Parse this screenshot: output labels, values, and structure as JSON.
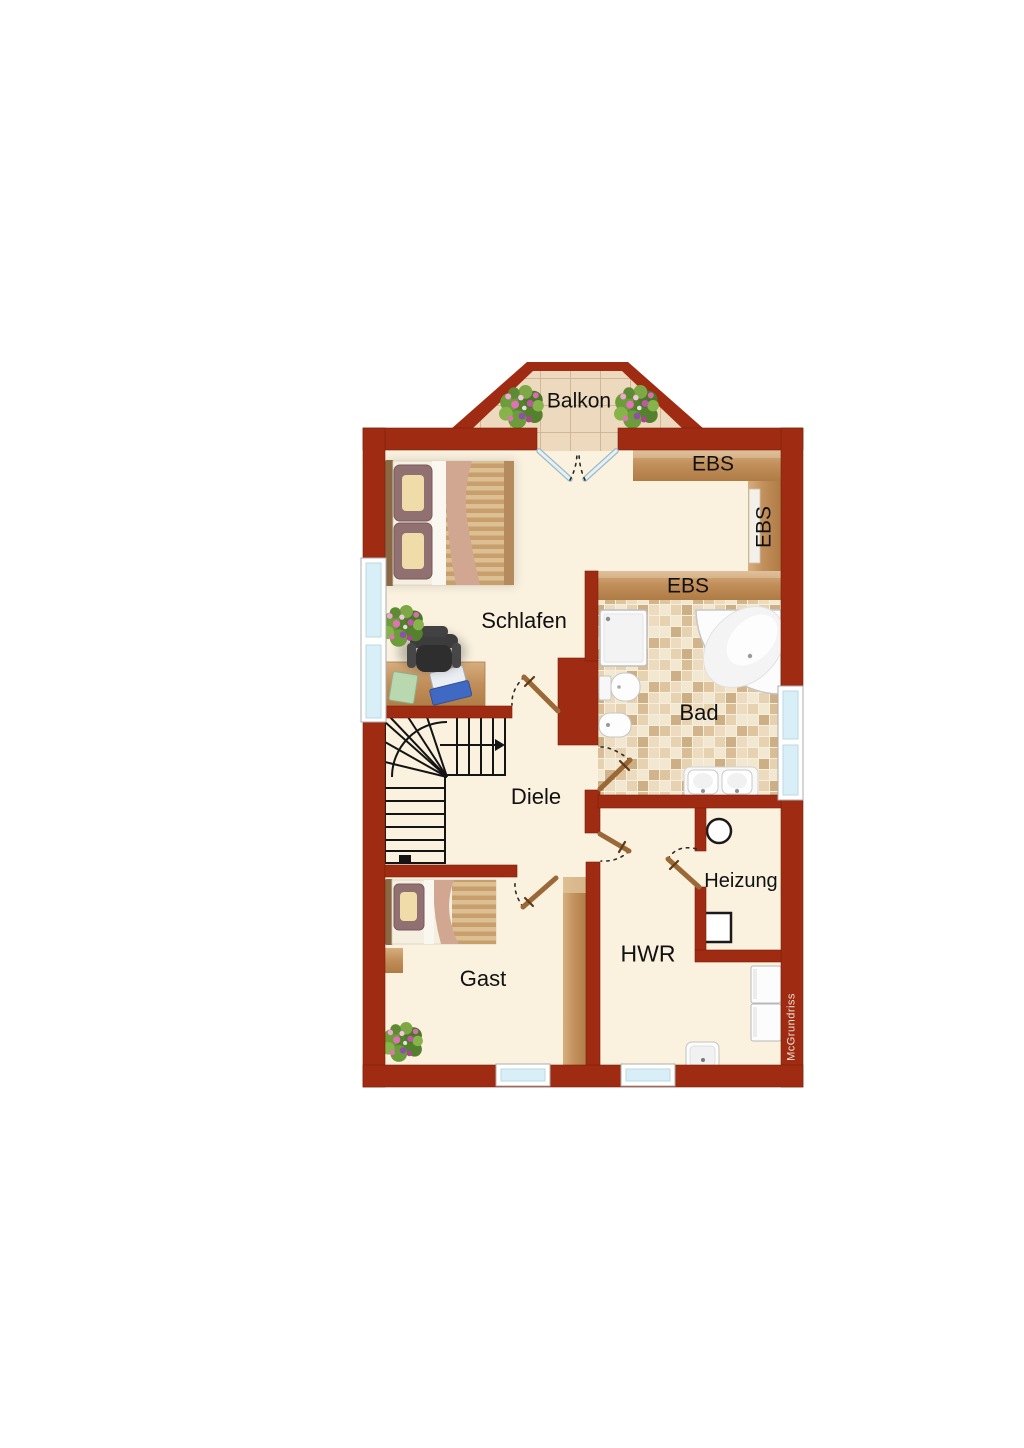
{
  "floorplan": {
    "rooms": {
      "balkon": "Balkon",
      "schlafen": "Schlafen",
      "bad": "Bad",
      "diele": "Diele",
      "heizung": "Heizung",
      "hwr": "HWR",
      "gast": "Gast"
    },
    "wardrobes": {
      "top": "EBS",
      "right": "EBS",
      "middle": "EBS"
    },
    "watermark": "McGrundriss",
    "colors": {
      "wall": "#9E2B12",
      "floor": "#FAF1DF",
      "wood": "#C79A69",
      "bath_tile": "#E9D6B6",
      "balcony_tile": "#EDD9BD",
      "window_glass": "#D8EFF8",
      "door_leaf": "#9A6937",
      "label_text": "#111111"
    }
  }
}
